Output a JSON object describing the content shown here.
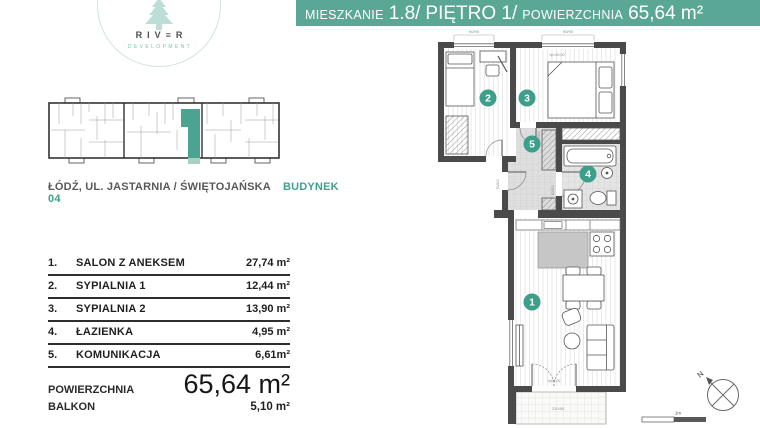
{
  "brand": {
    "name": "RIV≡R",
    "subtitle": "DEVELOPMENT"
  },
  "header": {
    "unit_label": "MIESZKANIE",
    "unit_number": "1.8/",
    "floor": "PIĘTRO 1/",
    "area_label": "POWIERZCHNIA",
    "area_value": "65,64 m²"
  },
  "location": {
    "address": "ŁÓDŹ, UL. JASTARNIA / ŚWIĘTOJAŃSKA",
    "building": "BUDYNEK 04"
  },
  "room_table": {
    "rows": [
      {
        "no": "1.",
        "name": "SALON Z ANEKSEM",
        "area": "27,74 m²"
      },
      {
        "no": "2.",
        "name": "SYPIALNIA 1",
        "area": "12,44 m²"
      },
      {
        "no": "3.",
        "name": "SYPIALNIA 2",
        "area": "13,90 m²"
      },
      {
        "no": "4.",
        "name": "ŁAZIENKA",
        "area": "4,95 m²"
      },
      {
        "no": "5.",
        "name": "KOMUNIKACJA",
        "area": "6,61m²"
      }
    ]
  },
  "summary": {
    "area_label": "POWIERZCHNIA",
    "area_value": "65,64 m²",
    "balcony_label": "BALKON",
    "balcony_value": "5,10 m²"
  },
  "floorplan": {
    "numbers": {
      "salon": "1",
      "bedroom1": "2",
      "bedroom2": "3",
      "bathroom": "4",
      "hall": "5"
    },
    "annotations": {
      "win_dim1": "90/90",
      "win_dim2": "90/90",
      "hp1": "hp=90,00",
      "hp2": "hp=90,00",
      "door1": "80/200",
      "door2": "90/200",
      "door3": "80/200",
      "balcony_door": "hp=0,00",
      "balcony_dim": "230/85"
    },
    "compass_label": "N",
    "scale_label": "1m"
  },
  "colors": {
    "teal_bar": "#5ba796",
    "teal_accent": "#3d9e8a",
    "mint": "#bcded6",
    "wall": "#4a4a4a"
  }
}
